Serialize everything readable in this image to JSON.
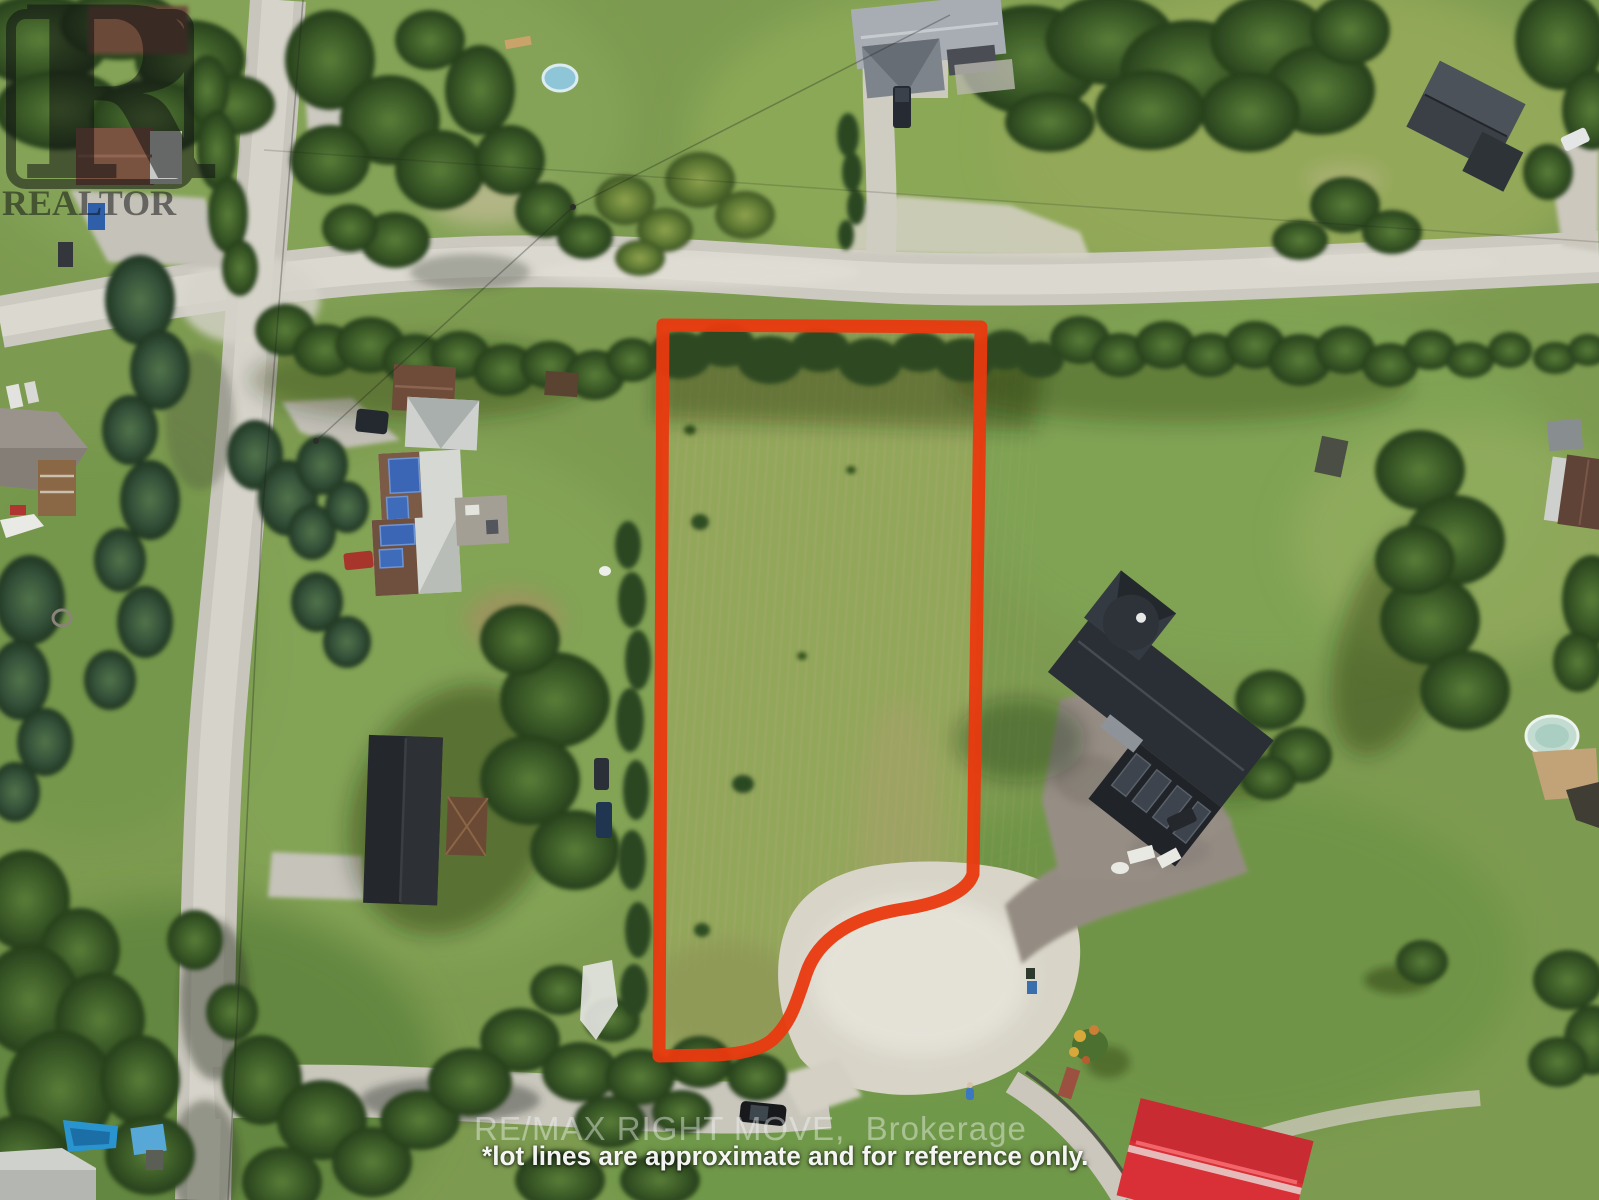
{
  "photo": {
    "type": "aerial-drone-real-estate-photo",
    "subject": "vacant rural building lot outlined in red, surrounded by homes, lawns, trees and gravel roads"
  },
  "watermarks": {
    "realtor_logo_letter": "R",
    "realtor_logo_text": "REALTOR",
    "brokerage_line": "RE/MAX RIGHT MOVE,  Brokerage",
    "disclaimer_line": "*lot lines are approximate and for reference only."
  },
  "palette": {
    "lot_outline_red": "#e9390f",
    "grass_green": "#7d9b50",
    "road_gravel": "#d6d3c9",
    "dark_roof": "#23272c",
    "red_roof": "#d92f36",
    "solar_panel_blue": "#3a66b5",
    "boat_blue": "#2a94cf"
  }
}
